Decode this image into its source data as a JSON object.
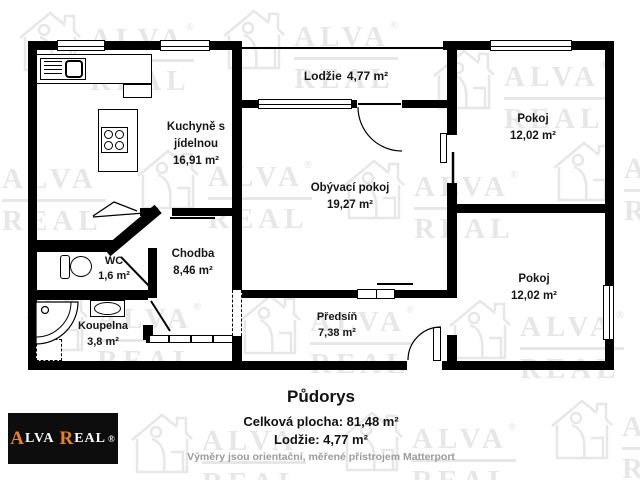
{
  "watermark": {
    "alva": "ALVA",
    "real": "REAL",
    "reg": "®"
  },
  "rooms": {
    "kitchen": {
      "name_line1": "Kuchyně s",
      "name_line2": "jídelnou",
      "area": "16,91 m²"
    },
    "loggia": {
      "name": "Lodžie",
      "area": "4,77 m²"
    },
    "living": {
      "name": "Obývací pokoj",
      "area": "19,27 m²"
    },
    "room1": {
      "name": "Pokoj",
      "area": "12,02 m²"
    },
    "room2": {
      "name": "Pokoj",
      "area": "12,02 m²"
    },
    "hallway": {
      "name": "Chodba",
      "area": "8,46 m²"
    },
    "wc": {
      "name": "WC",
      "area": "1,6 m²"
    },
    "bathroom": {
      "name": "Koupelna",
      "area": "3,8 m²"
    },
    "entry": {
      "name": "Předsíň",
      "area": "7,38 m²"
    }
  },
  "footer": {
    "title": "Půdorys",
    "total_area": "Celková plocha: 81,48 m²",
    "loggia_area": "Lodžie: 4,77 m²",
    "disclaimer": "Výměry jsou orientační, měřené přístrojem Matterport"
  },
  "logo": {
    "a1": "A",
    "rest1": "LVA",
    "a2": "R",
    "rest2": "EAL",
    "reg": "®"
  },
  "colors": {
    "accent": "#e8821e",
    "wall": "#000000",
    "watermark": "#e7e7e7",
    "disclaimer": "#9b9b9b"
  }
}
